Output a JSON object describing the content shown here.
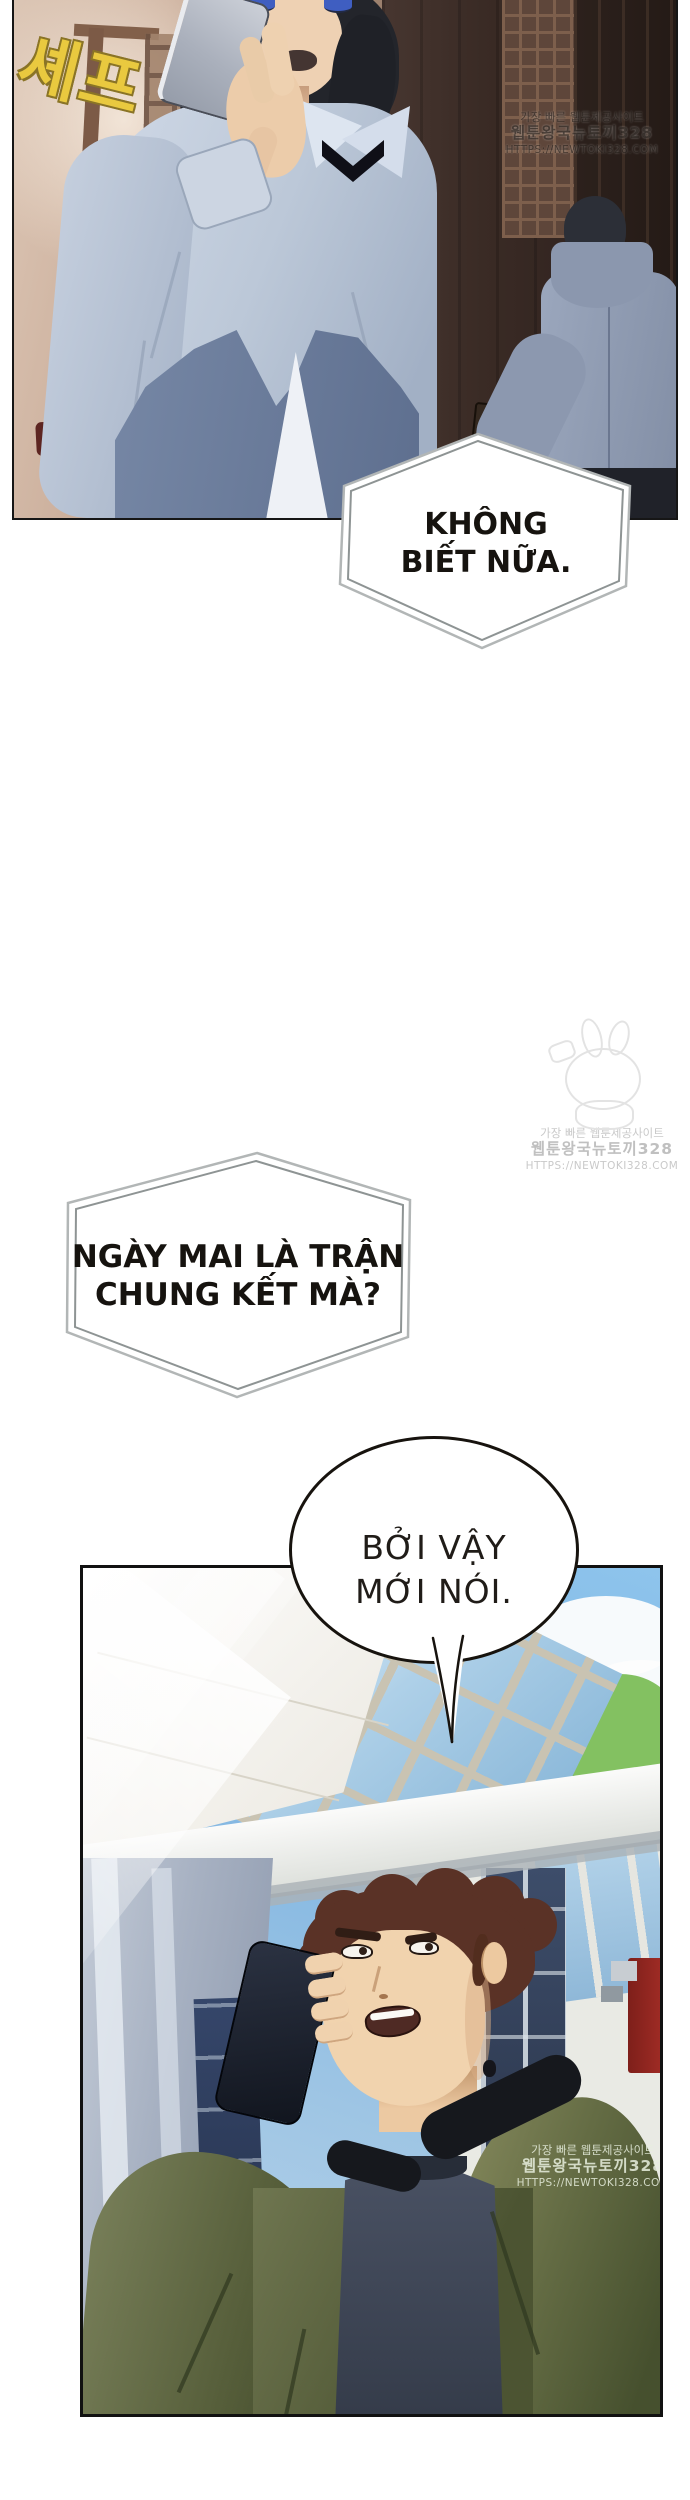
{
  "comic": {
    "poster_text": "셰프",
    "bubbles": [
      {
        "name": "dont-know",
        "shape": "hexagon",
        "lines": [
          "KHÔNG",
          "BIẾT NỮA."
        ]
      },
      {
        "name": "final-match",
        "shape": "hexagon",
        "lines": [
          "NGÀY MAI LÀ TRẬN",
          "CHUNG KẾT MÀ?"
        ]
      },
      {
        "name": "thats-why",
        "shape": "ellipse",
        "lines": [
          "BỞI VẬY",
          "MỚI NÓI."
        ]
      }
    ],
    "watermark": {
      "line1": "가장 빠른 웹툰제공사이트",
      "line2": "웹툰왕국뉴토끼328",
      "line3": "HTTPS://NEWTOKI328.COM"
    },
    "colors": {
      "poster_yellow": "#e9c93f",
      "jacket_olive": "#5f6742",
      "sky_blue": "#7db4e2",
      "machine_red": "#9e2a24"
    }
  }
}
